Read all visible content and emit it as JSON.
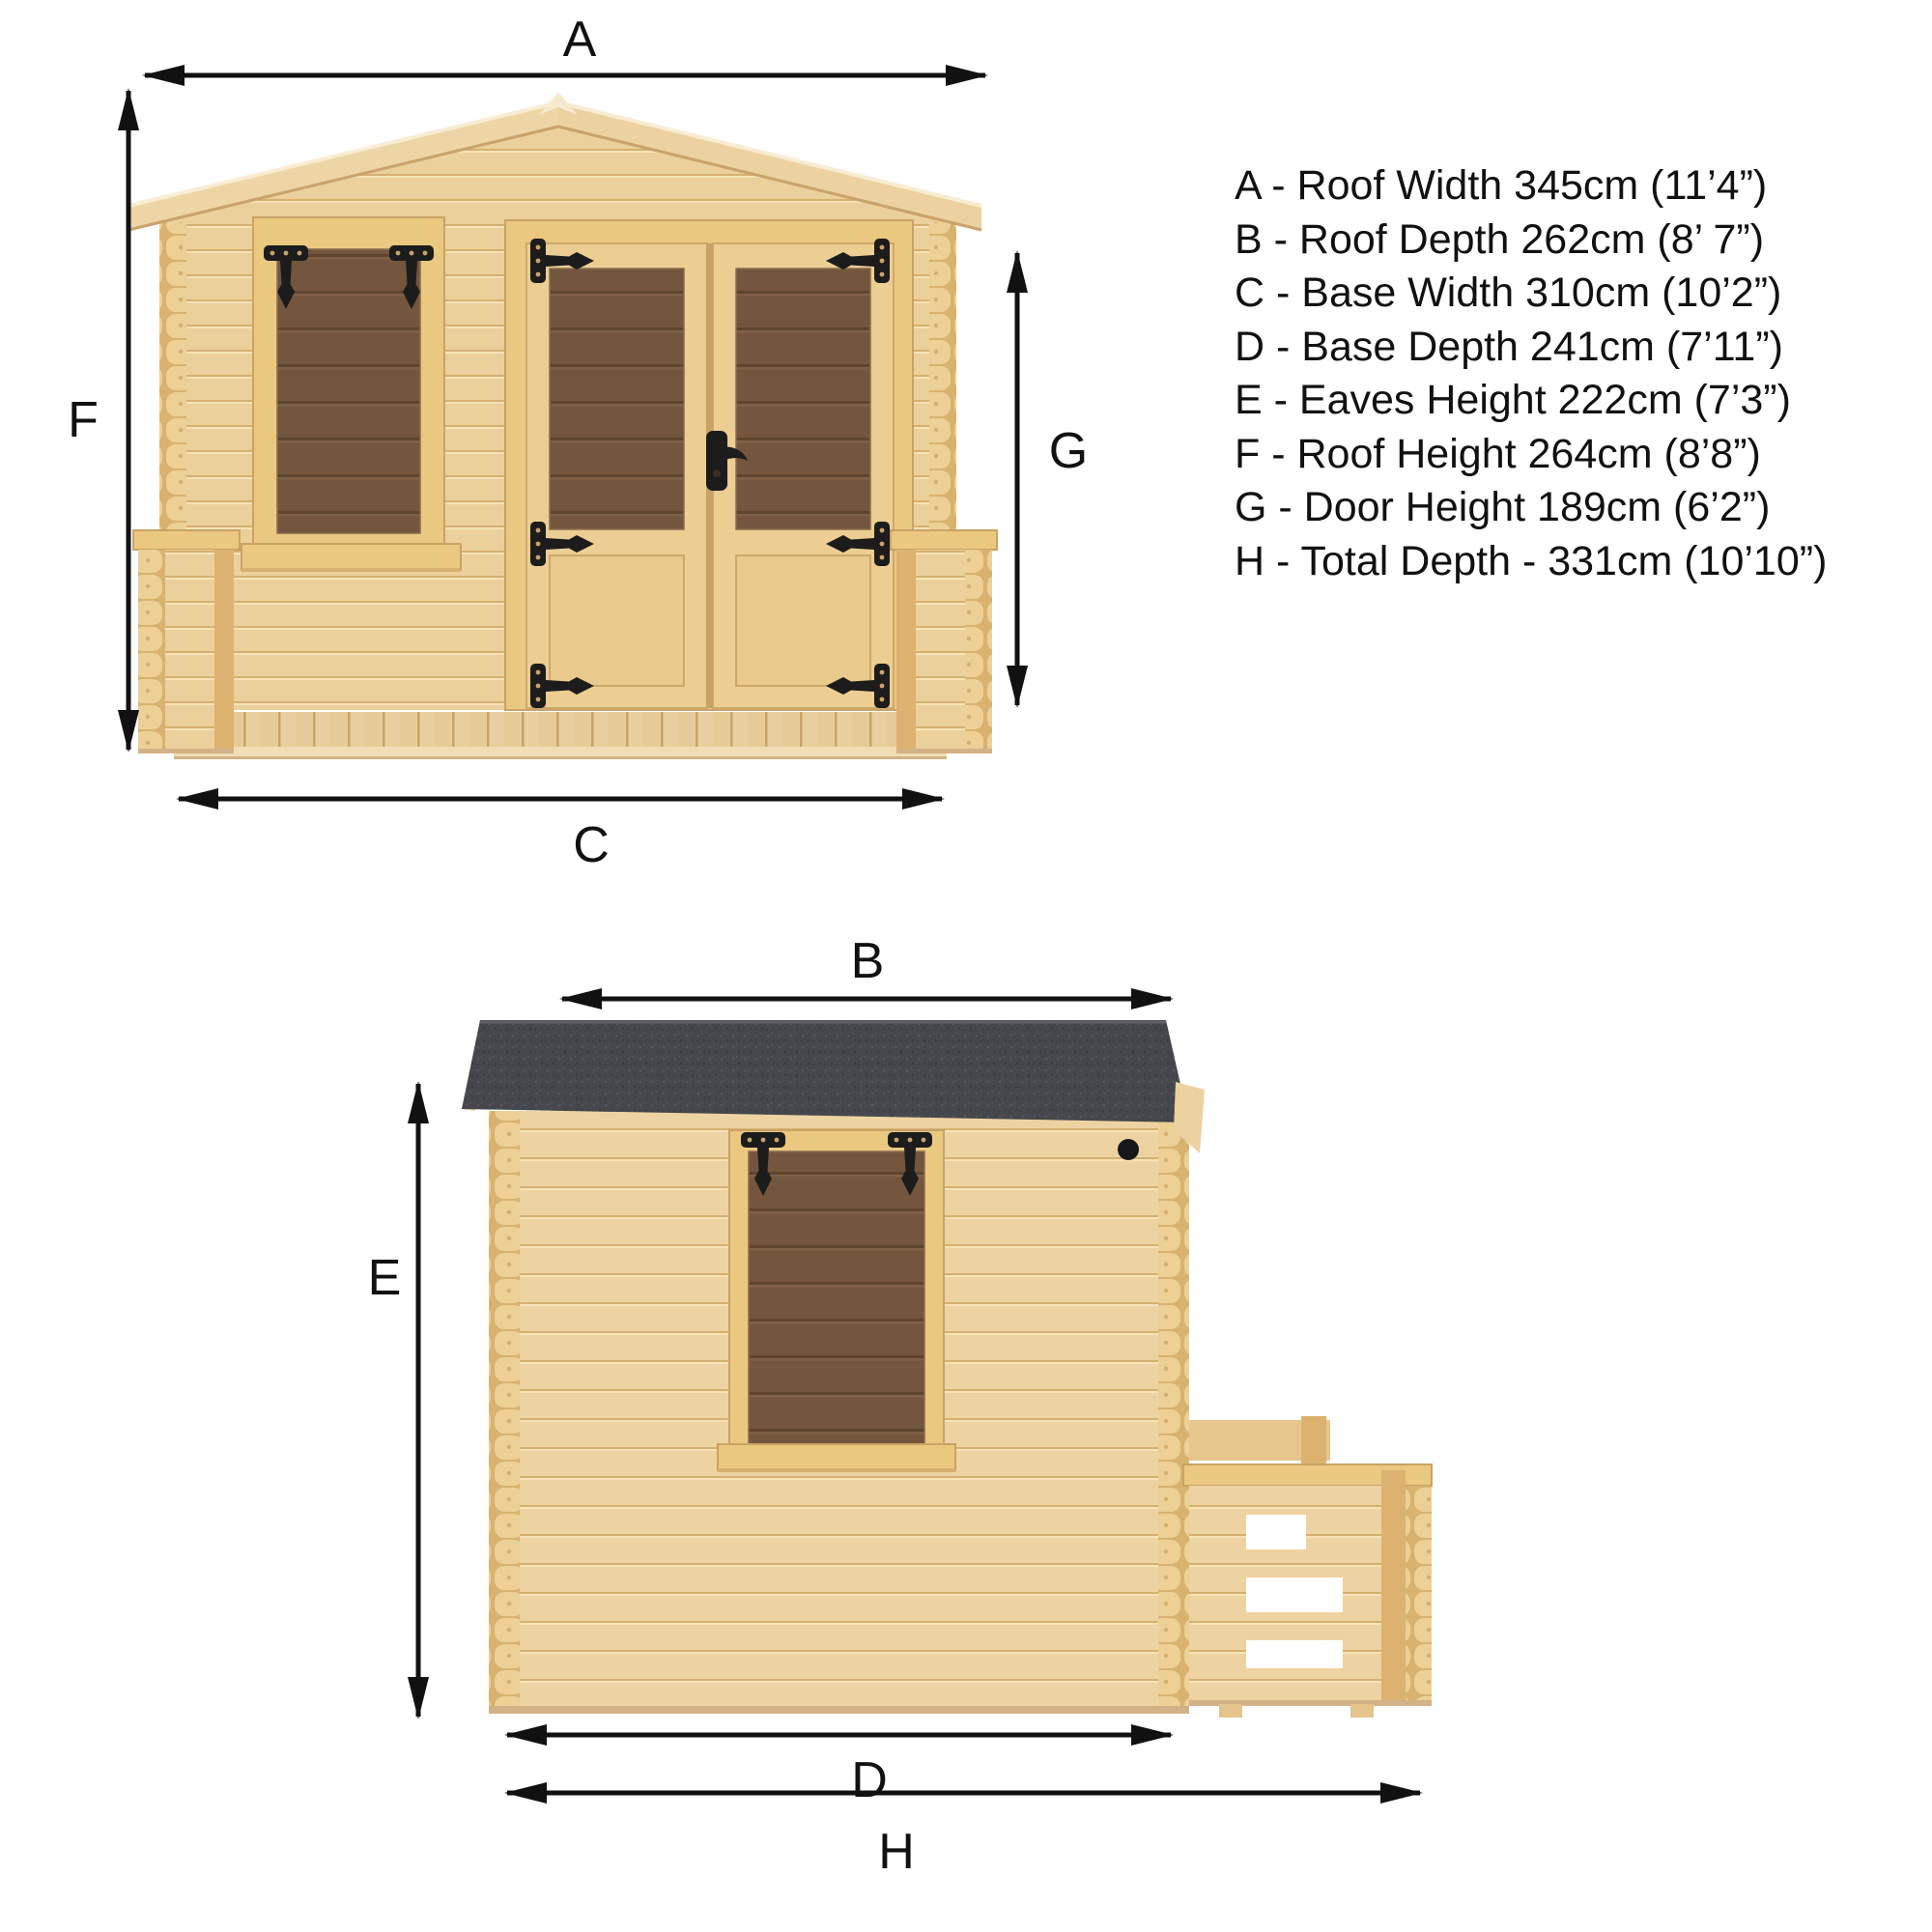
{
  "dims": {
    "a": "A",
    "b": "B",
    "c": "C",
    "d": "D",
    "e": "E",
    "f": "F",
    "g": "G",
    "h": "H"
  },
  "legend": {
    "items": [
      {
        "text": "A - Roof Width 345cm (11’4”)"
      },
      {
        "text": "B - Roof Depth 262cm (8’ 7”)"
      },
      {
        "text": "C - Base Width 310cm (10’2”)"
      },
      {
        "text": "D - Base Depth 241cm (7’11”)"
      },
      {
        "text": "E - Eaves Height 222cm (7’3”)"
      },
      {
        "text": "F - Roof Height 264cm (8’8”)"
      },
      {
        "text": "G - Door Height 189cm (6’2”)"
      },
      {
        "text": "H - Total Depth - 331cm (10’10”)"
      }
    ]
  },
  "colors": {
    "ink": "#111111",
    "wood": "#ecd09b",
    "wood_light": "#f6e3b7",
    "wood_line": "#d5b06f",
    "wood_side": "#eed3a2",
    "wood_frame": "#eac87f",
    "wood_deep": "#ddb271",
    "glass": "#73563d",
    "glass_line": "#5e4530",
    "glass_hi": "#7f6147",
    "roof_felt": "#45474c",
    "felt_light": "#54565c",
    "felt_dark": "#383a3f",
    "hinge": "#1c1c1c",
    "background": "#ffffff"
  }
}
